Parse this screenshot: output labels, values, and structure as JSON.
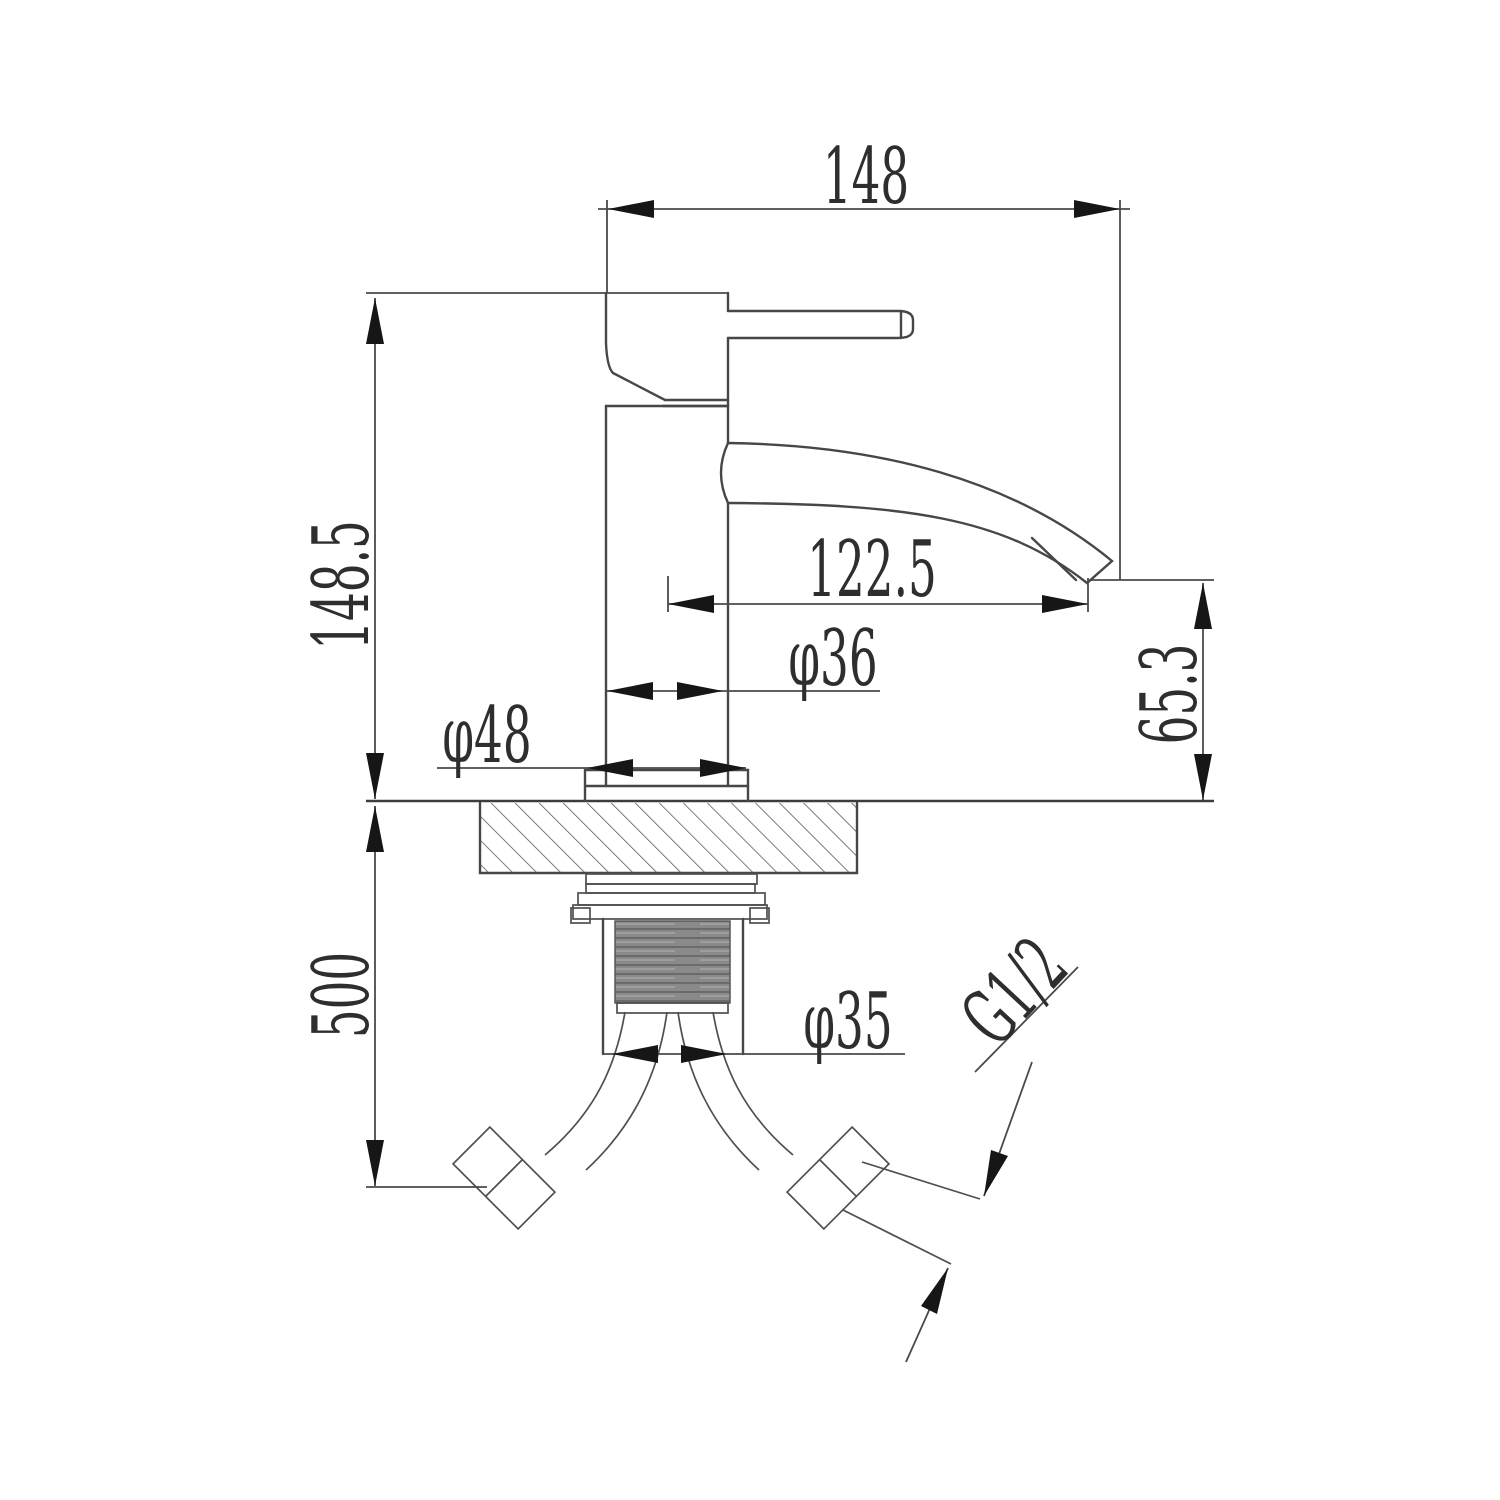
{
  "drawing": {
    "type": "faucet-installation-dimension-drawing",
    "units_implied": "mm",
    "dimensions": {
      "overall_width": "148",
      "body_height_above_deck": "148.5",
      "spout_reach": "122.5",
      "body_diameter": "φ36",
      "base_flange_diameter": "φ48",
      "spout_outlet_height": "65.3",
      "hose_drop_length": "500",
      "shank_diameter": "φ35",
      "thread_spec": "G1/2"
    },
    "colors": {
      "line": "#474747",
      "arrow": "#161616",
      "background": "#ffffff",
      "thread_fill": "#8a8a8a"
    }
  }
}
